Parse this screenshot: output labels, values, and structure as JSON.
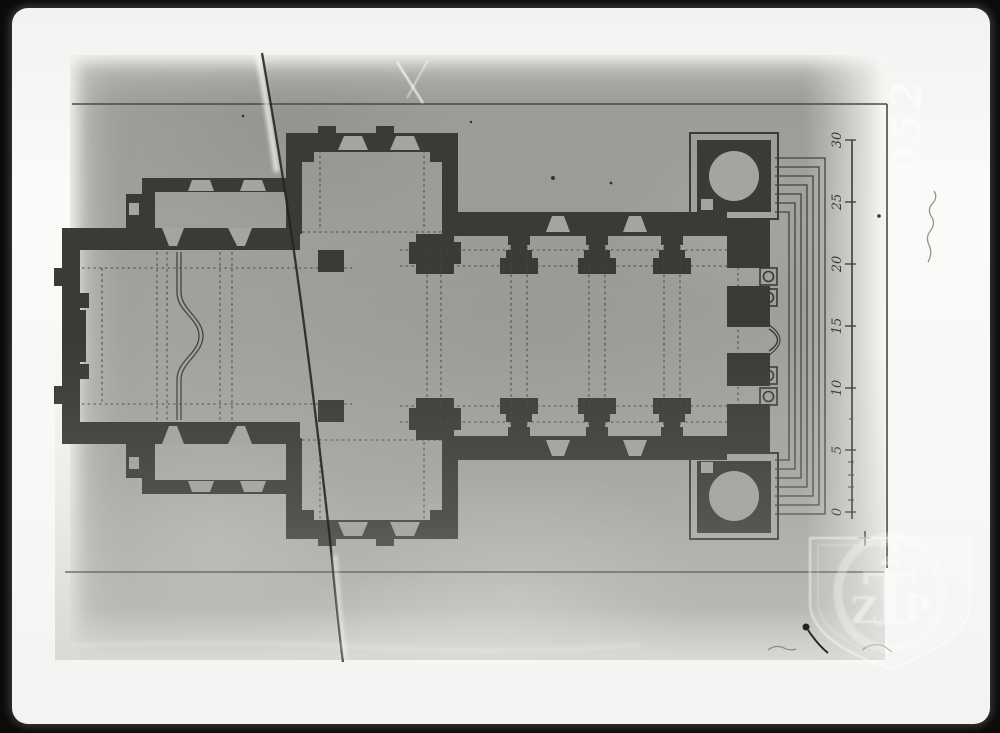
{
  "photograph": {
    "inventory_number": "4052",
    "scale_bar": {
      "labels": [
        "30",
        "25",
        "20",
        "15",
        "10",
        "5",
        "0"
      ]
    },
    "watermark": {
      "top_glyph": "2",
      "letter_left": "Z",
      "letter_center": "T",
      "letter_right": "P"
    },
    "colors": {
      "scan_background": "#0b0b0a",
      "print_paper": "#f7f7f5",
      "photo_gray": "#a1a19d",
      "plan_ink": "#3b3b35",
      "inventory_white": "#fbfbf9"
    }
  }
}
